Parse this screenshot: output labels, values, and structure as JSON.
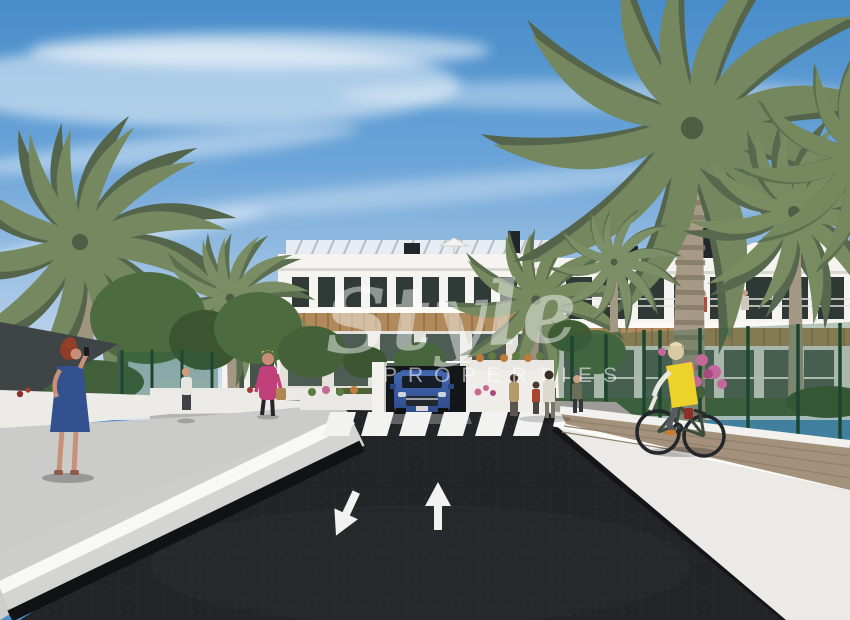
{
  "scene": {
    "type": "architectural-render",
    "description": "Street-level CGI render of a new-build apartment complex with palm trees, two-lane road, pedestrian crossing, underground garage exit, pedestrians and a cyclist",
    "watermark": {
      "line1": "Style",
      "line2": "PROPERTIES"
    },
    "road": {
      "lanes": 2,
      "left_arrow_direction": "toward viewer (down-left)",
      "right_arrow_direction": "away from viewer (up)",
      "crosswalk_stripes": 6
    },
    "people": [
      "woman with red hair in blue dress walking on left sidewalk",
      "man in white t-shirt on background path",
      "woman in pink top with handbag near crossing",
      "group of pedestrians by right building entrance",
      "cyclist in yellow vest on right paver path",
      "two residents on right balcony"
    ],
    "vehicles": [
      "blue SUV exiting underground garage ramp"
    ]
  },
  "palette": {
    "sky_top": "#4c90cb",
    "sky_horizon": "#dfe9f3",
    "road": "#232428",
    "road_marking": "#f2f2f0",
    "sidewalk": "#cbcbc9",
    "wall_white": "#eceae6",
    "paver_path": "#a3917b",
    "building_white": "#f5f4f0",
    "window_dark": "#2f3a38",
    "wood_canopy": "#b08a5a",
    "palm_green": "#77895f",
    "tree_green": "#4c6b3f",
    "fence_green": "#2c5c41",
    "shade_sail": "#3f4447",
    "car_blue": "#3a5fa8",
    "dress_blue": "#33518f",
    "top_pink": "#c2407a",
    "vest_yellow": "#edd22c",
    "flower_pink": "#c4679a"
  }
}
